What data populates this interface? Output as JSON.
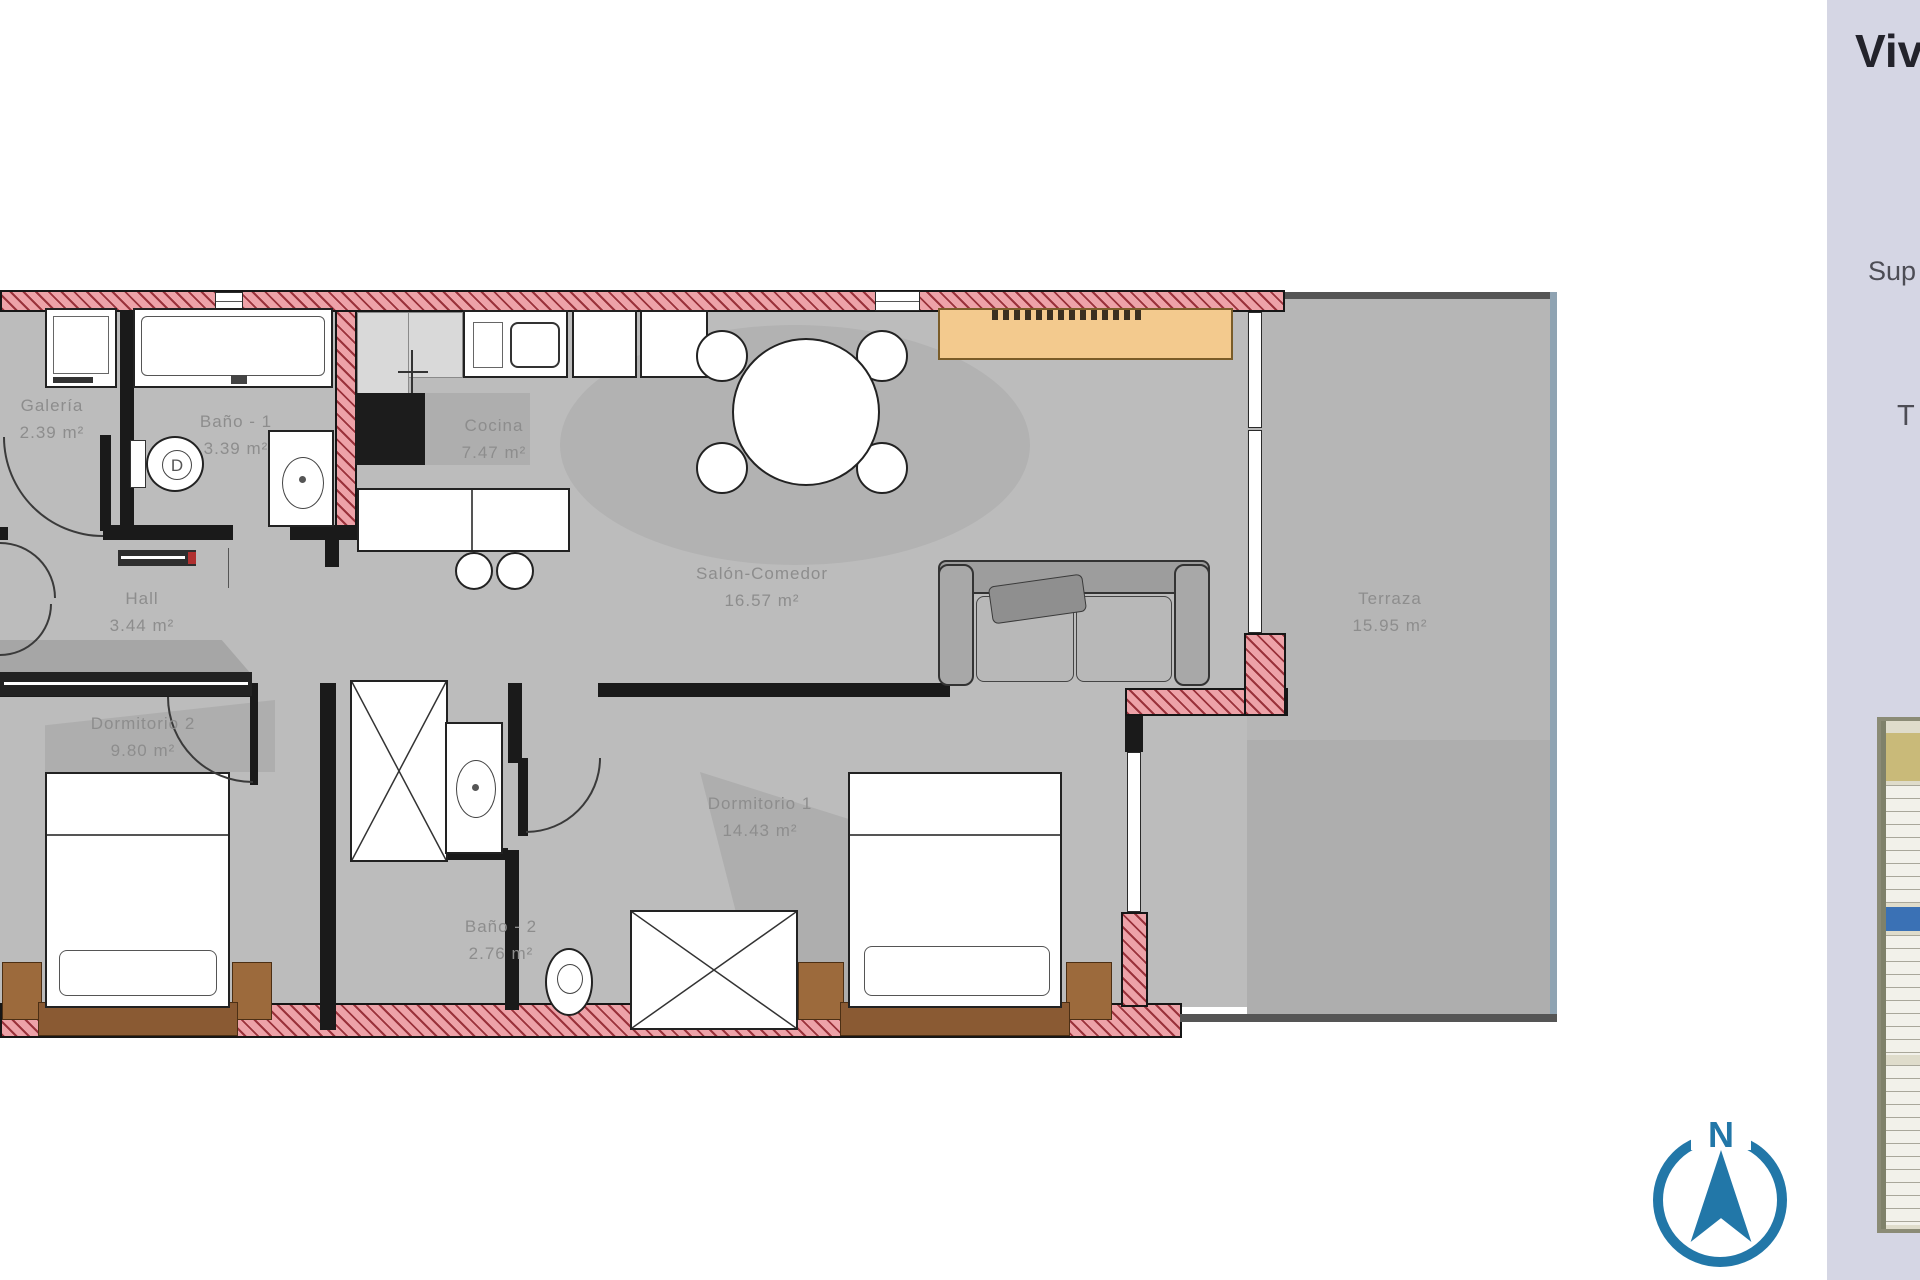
{
  "plan": {
    "rooms": [
      {
        "name": "Galería",
        "area": "2.39 m²"
      },
      {
        "name": "Baño - 1",
        "area": "3.39 m²"
      },
      {
        "name": "Cocina",
        "area": "7.47 m²"
      },
      {
        "name": "Hall",
        "area": "3.44 m²"
      },
      {
        "name": "Salón-Comedor",
        "area": "16.57 m²"
      },
      {
        "name": "Dormitorio 2",
        "area": "9.80 m²"
      },
      {
        "name": "Dormitorio 1",
        "area": "14.43 m²"
      },
      {
        "name": "Baño - 2",
        "area": "2.76 m²"
      },
      {
        "name": "Terraza",
        "area": "15.95 m²"
      }
    ],
    "fixtures": {
      "toilet_mark": "D"
    }
  },
  "side_panel": {
    "title_fragment": "Viv",
    "superficie_fragment": "Sup",
    "terraza_fragment": "T"
  },
  "compass": {
    "north_label": "N"
  },
  "colors": {
    "wall_fill": "#eda2a8",
    "wall_hatch": "#8c1e28",
    "floor": "#bcbcbc",
    "panel_bg": "#d5d6e4",
    "compass_blue": "#2277a8",
    "wood_brown": "#8a5a33",
    "sideboard_tan": "#f3ca8e",
    "siteplan_band_blue": "#3a71b5"
  }
}
